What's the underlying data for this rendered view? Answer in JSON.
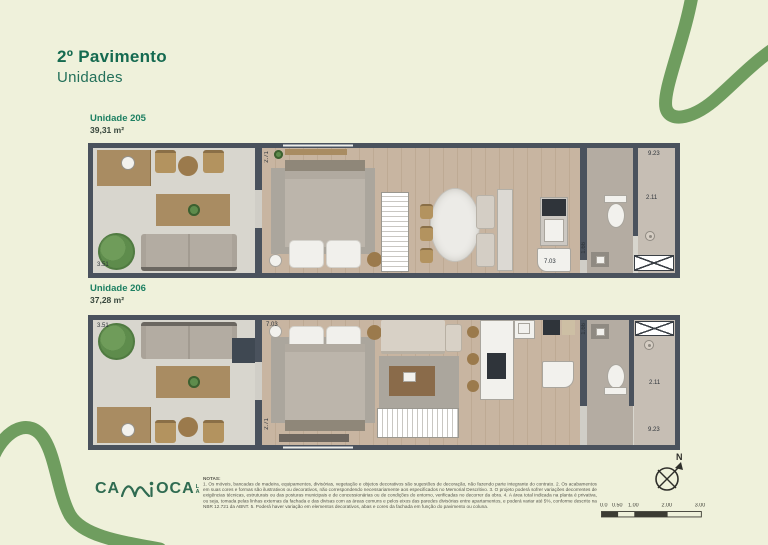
{
  "header": {
    "title": "2º Pavimento",
    "subtitle": "Unidades"
  },
  "units": [
    {
      "name": "Unidade 205",
      "area": "39,31 m²",
      "dims": {
        "living": "3.51",
        "bed": "2.71",
        "length": "9.23",
        "bath_w": "2.11",
        "kitchen": "7.03",
        "bath_h": "1.66"
      }
    },
    {
      "name": "Unidade 206",
      "area": "37,28 m²",
      "dims": {
        "living": "3.51",
        "bed": "2.71",
        "length": "9.23",
        "bath_w": "2.11",
        "kitchen": "7.03",
        "bath_h": "1.66"
      }
    }
  ],
  "footer": {
    "logo": {
      "left": "CA",
      "right": "OCA",
      "tag_top": "L",
      "tag_bottom": "A"
    },
    "notes_title": "NOTAS:",
    "notes_body": "1. Os móveis, bancadas de madeira, equipamentos, divisórias, vegetação e objetos decorativos são sugestões de decoração, não fazendo parte integrante do contrato. 2. Os acabamentos em suas cores e formas são ilustrativos ou decorativos, não correspondendo necessariamente aos especificados no Memorial Descritivo. 3. O projeto poderá sofrer variações decorrentes de exigências técnicas, estruturais ou das posturas municipais e de concessionárias ou de condições do entorno, verificadas no decorrer da obra. 4. A área total indicada na planta é privativa, ou seja, tomada pelas linhas externas da fachada e das divisas com as áreas comuns e pelos eixos das paredes divisórias entre apartamentos, e poderá variar até 5%, conforme descrito na NBR 12.721 da ABNT. 5. Poderá haver variação em elementos decorativos, abas e cores da fachada em função do pavimento ou coluna.",
    "compass_n": "N",
    "scale_labels": [
      "0.0",
      "0.50",
      "1.00",
      "2.00",
      "3.00"
    ]
  },
  "colors": {
    "background": "#eff1db",
    "accent_green": "#6f9d5f",
    "title_green": "#156a50",
    "wall": "#4a525d"
  }
}
